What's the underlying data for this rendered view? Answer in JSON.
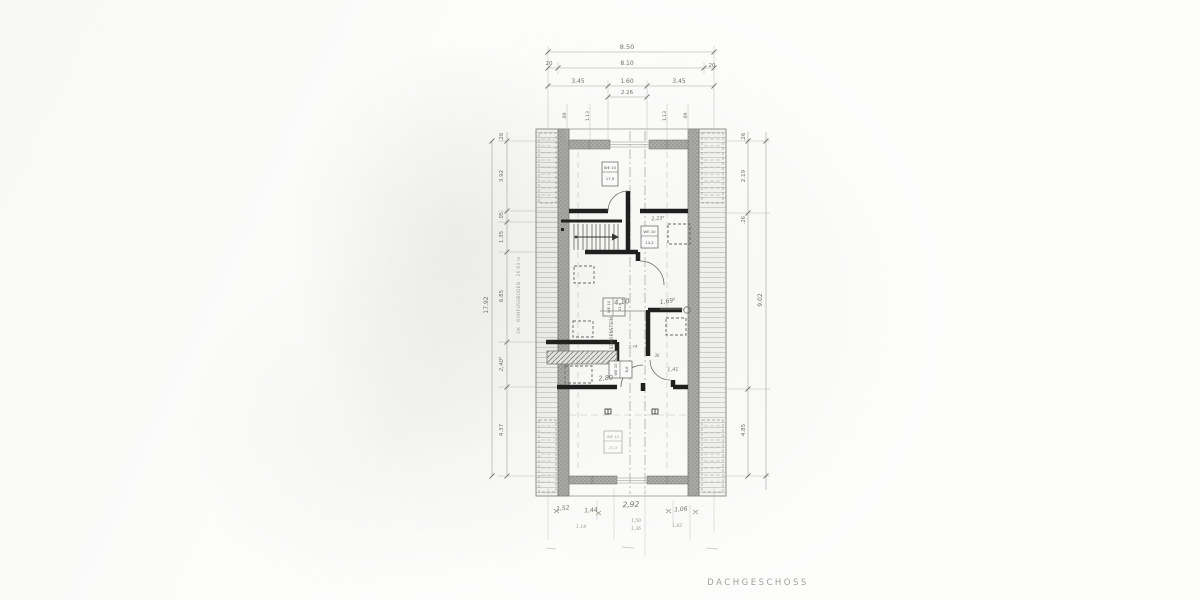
{
  "page": {
    "floor_label": "DACHGESCHOSS"
  },
  "plan": {
    "chimney_label": "SCHORNSTEIN",
    "datum_note": "OK · ROHFUSSBODEN · 26,63 m"
  },
  "dims": {
    "top": {
      "total": "8.50",
      "wl": "20",
      "inner": "8.10",
      "wr": "20",
      "s1": "3.45",
      "s2": "1.60",
      "s3": "3.45",
      "s4": "2.26",
      "w1": ".89",
      "w2": "1.13",
      "w3": "1.13",
      "w4": ".89"
    },
    "left": {
      "v1": ".26",
      "v2": "3.92",
      "v3": ".05",
      "v4": "1.35",
      "v5": "6.85",
      "v6": "2,40⁵",
      "v7": "4.37",
      "outer": "17.92"
    },
    "right": {
      "v1": ".26",
      "v2": "2.19",
      "v3": ".26",
      "v4": "4.85",
      "outer": "9.02"
    },
    "bottom": {
      "b1": "1,52",
      "b2": "1,44",
      "b3": "2,92",
      "b4": "1,06",
      "b5": "1,14",
      "b6": "1,50",
      "b7": "1,36",
      "b8": "1,43"
    }
  },
  "pencil": {
    "p1": "4,10",
    "p2": "1,69⁵",
    "p3": "2,23⁵",
    "p4": "7,74",
    "p5": "36",
    "p6": "2,80",
    "p7": "1,41"
  },
  "stamps": [
    {
      "l1": "WE 10",
      "l2": "17,9"
    },
    {
      "l1": "WE 10",
      "l2": "14,2"
    },
    {
      "l1": "WE 10",
      "l2": "11,4"
    },
    {
      "l1": "WE 10",
      "l2": "8,6"
    },
    {
      "l1": "WE 10",
      "l2": "21,3"
    }
  ],
  "colors": {
    "wall_black": "#1b1b1b",
    "wall_gray": "#ababa8",
    "pencil_gray": "#72726b",
    "print_gray": "#6e6e6a"
  }
}
